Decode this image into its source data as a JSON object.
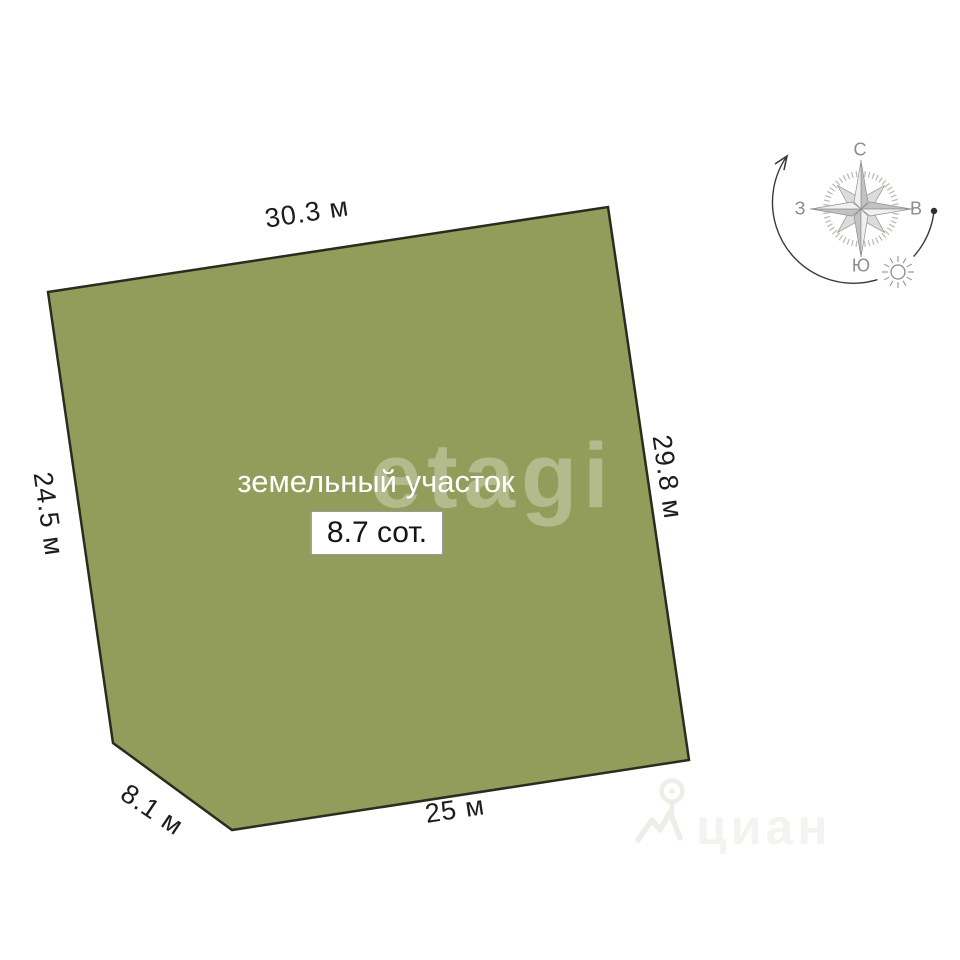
{
  "plot": {
    "label": "земельный участок",
    "area_label": "8.7 сот.",
    "fill_color": "#939D5B",
    "stroke_color": "#2B2B1E",
    "dimensions": {
      "top": "30.3 м",
      "right": "29.8 м",
      "bottom": "25 м",
      "diagonal": "8.1 м",
      "left": "24.5 м"
    }
  },
  "compass": {
    "north": "С",
    "south": "Ю",
    "west": "З",
    "east": "В"
  },
  "watermarks": {
    "etagi": "etagi",
    "cian": "циан"
  }
}
